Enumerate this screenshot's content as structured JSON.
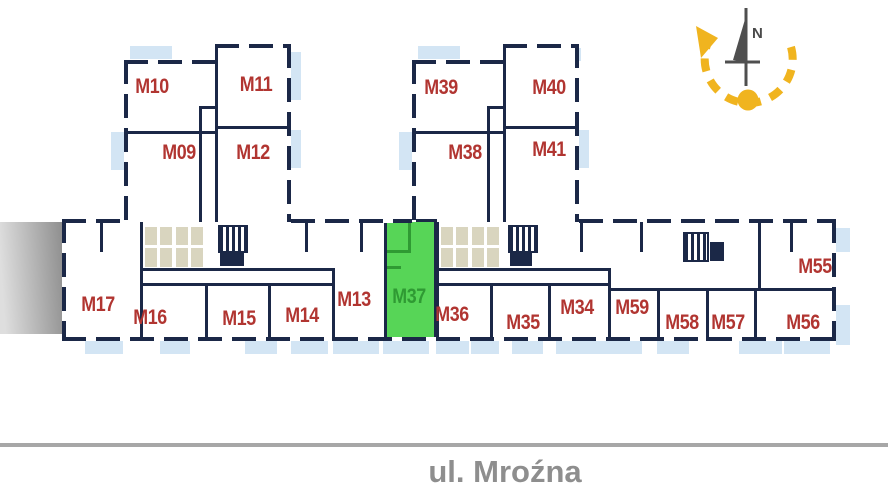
{
  "plan": {
    "street": {
      "label": "ul. Mroźna"
    },
    "compass": {
      "north_label": "N"
    },
    "selected_unit": "M37",
    "units": [
      {
        "label": "M10",
        "highlighted": false
      },
      {
        "label": "M11",
        "highlighted": false
      },
      {
        "label": "M09",
        "highlighted": false
      },
      {
        "label": "M12",
        "highlighted": false
      },
      {
        "label": "M39",
        "highlighted": false
      },
      {
        "label": "M40",
        "highlighted": false
      },
      {
        "label": "M38",
        "highlighted": false
      },
      {
        "label": "M41",
        "highlighted": false
      },
      {
        "label": "M17",
        "highlighted": false
      },
      {
        "label": "M16",
        "highlighted": false
      },
      {
        "label": "M15",
        "highlighted": false
      },
      {
        "label": "M14",
        "highlighted": false
      },
      {
        "label": "M13",
        "highlighted": false
      },
      {
        "label": "M37",
        "highlighted": true
      },
      {
        "label": "M36",
        "highlighted": false
      },
      {
        "label": "M35",
        "highlighted": false
      },
      {
        "label": "M34",
        "highlighted": false
      },
      {
        "label": "M59",
        "highlighted": false
      },
      {
        "label": "M58",
        "highlighted": false
      },
      {
        "label": "M57",
        "highlighted": false
      },
      {
        "label": "M56",
        "highlighted": false
      },
      {
        "label": "M55",
        "highlighted": false
      }
    ],
    "colors": {
      "wall": "#1b2847",
      "unit_label": "#b13531",
      "balcony": "#d3e5f4",
      "service_fill": "#d9d5bf",
      "selected_fill": "#57d557",
      "selected_label": "#2f9a33",
      "street_line": "#a7a7a7",
      "street_text": "#8e8e8e",
      "compass_arrow": "#f0b41f",
      "compass_needle": "#4f4f4f"
    }
  }
}
